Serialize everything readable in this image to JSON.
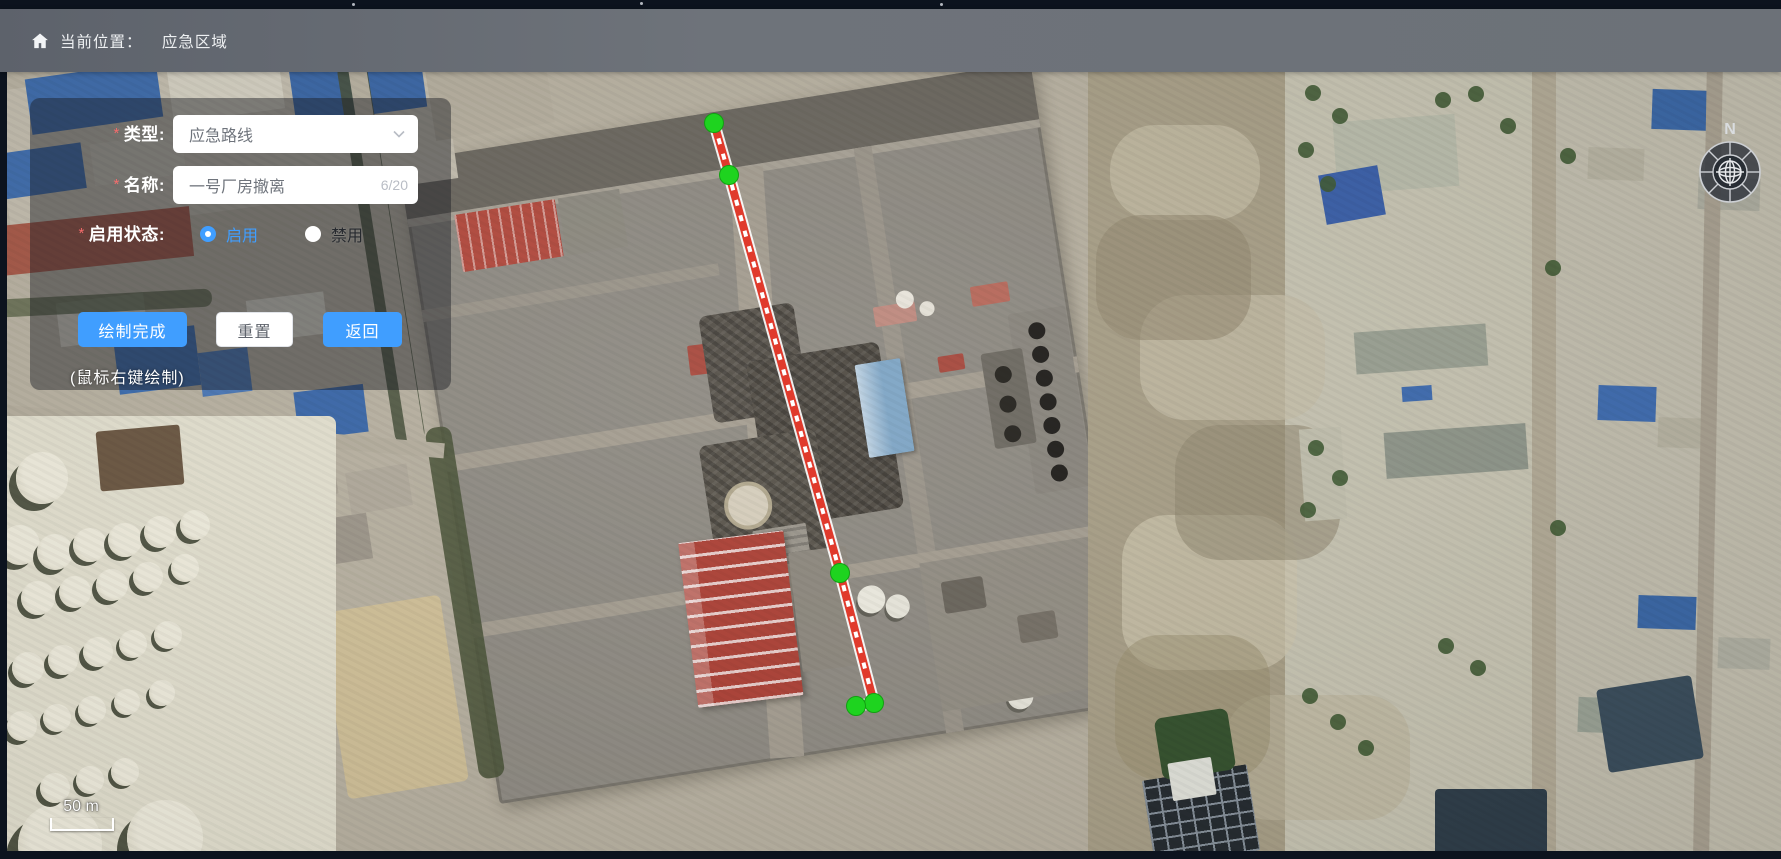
{
  "app": {
    "accent_color": "#409EFF"
  },
  "header": {
    "home_icon": "home-icon",
    "breadcrumb_prefix": "当前位置：",
    "location": "应急区域"
  },
  "panel": {
    "required_mark": "*",
    "type_field": {
      "label": "类型:",
      "value": "应急路线",
      "control": "select"
    },
    "name_field": {
      "label": "名称:",
      "value": "一号厂房撤离",
      "counter": "6/20"
    },
    "status_field": {
      "label": "启用状态:",
      "options": [
        {
          "label": "启用",
          "selected": true
        },
        {
          "label": "禁用",
          "selected": false
        }
      ]
    },
    "buttons": {
      "finish": "绘制完成",
      "reset": "重置",
      "back": "返回"
    },
    "hint": "(鼠标右键绘制)"
  },
  "map": {
    "scale_label": "50 m",
    "compass": {
      "north_label": "N"
    },
    "route": {
      "type": "emergency-route",
      "line_color": "#e03a2c",
      "node_color": "#1ed31f",
      "points": [
        [
          714,
          123
        ],
        [
          729,
          175
        ],
        [
          840,
          573
        ],
        [
          874,
          703
        ],
        [
          856,
          706
        ]
      ]
    }
  }
}
